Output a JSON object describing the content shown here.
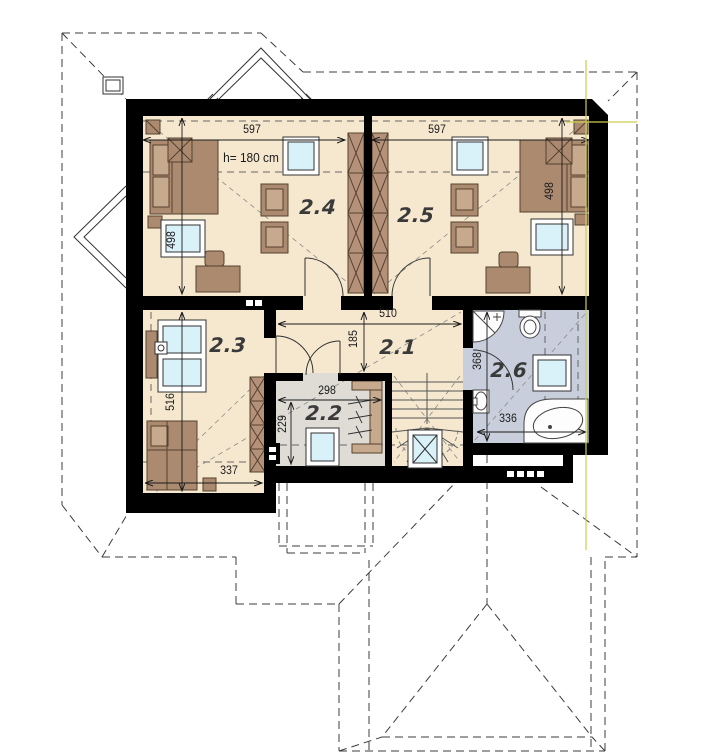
{
  "plan": {
    "type": "floor-plan-upper-storey",
    "annotations": {
      "ceiling_height": "h= 180 cm"
    },
    "rooms": {
      "r21": {
        "label": "2.1"
      },
      "r22": {
        "label": "2.2"
      },
      "r23": {
        "label": "2.3"
      },
      "r24": {
        "label": "2.4"
      },
      "r25": {
        "label": "2.5"
      },
      "r26": {
        "label": "2.6"
      }
    },
    "dimensions_cm": {
      "room24_width": "597",
      "room25_width": "597",
      "room24_depth": "498",
      "room25_depth": "498",
      "room23_depth": "516",
      "room23_width": "337",
      "hall_width": "510",
      "hall_depth": "185",
      "room22_width": "298",
      "room22_depth": "229",
      "bath_depth": "368",
      "bath_width": "336"
    },
    "colors": {
      "wall": "#000000",
      "floor_main": "#f5e8ce",
      "floor_utility": "#dedcd5",
      "floor_bath": "#c9cedc",
      "furniture": "#ab8a70",
      "furniture_light": "#c7a98e",
      "wardrobe": "#b5917a",
      "glass": "#d9f1f8",
      "guide_line": "#cdcd4e"
    }
  }
}
